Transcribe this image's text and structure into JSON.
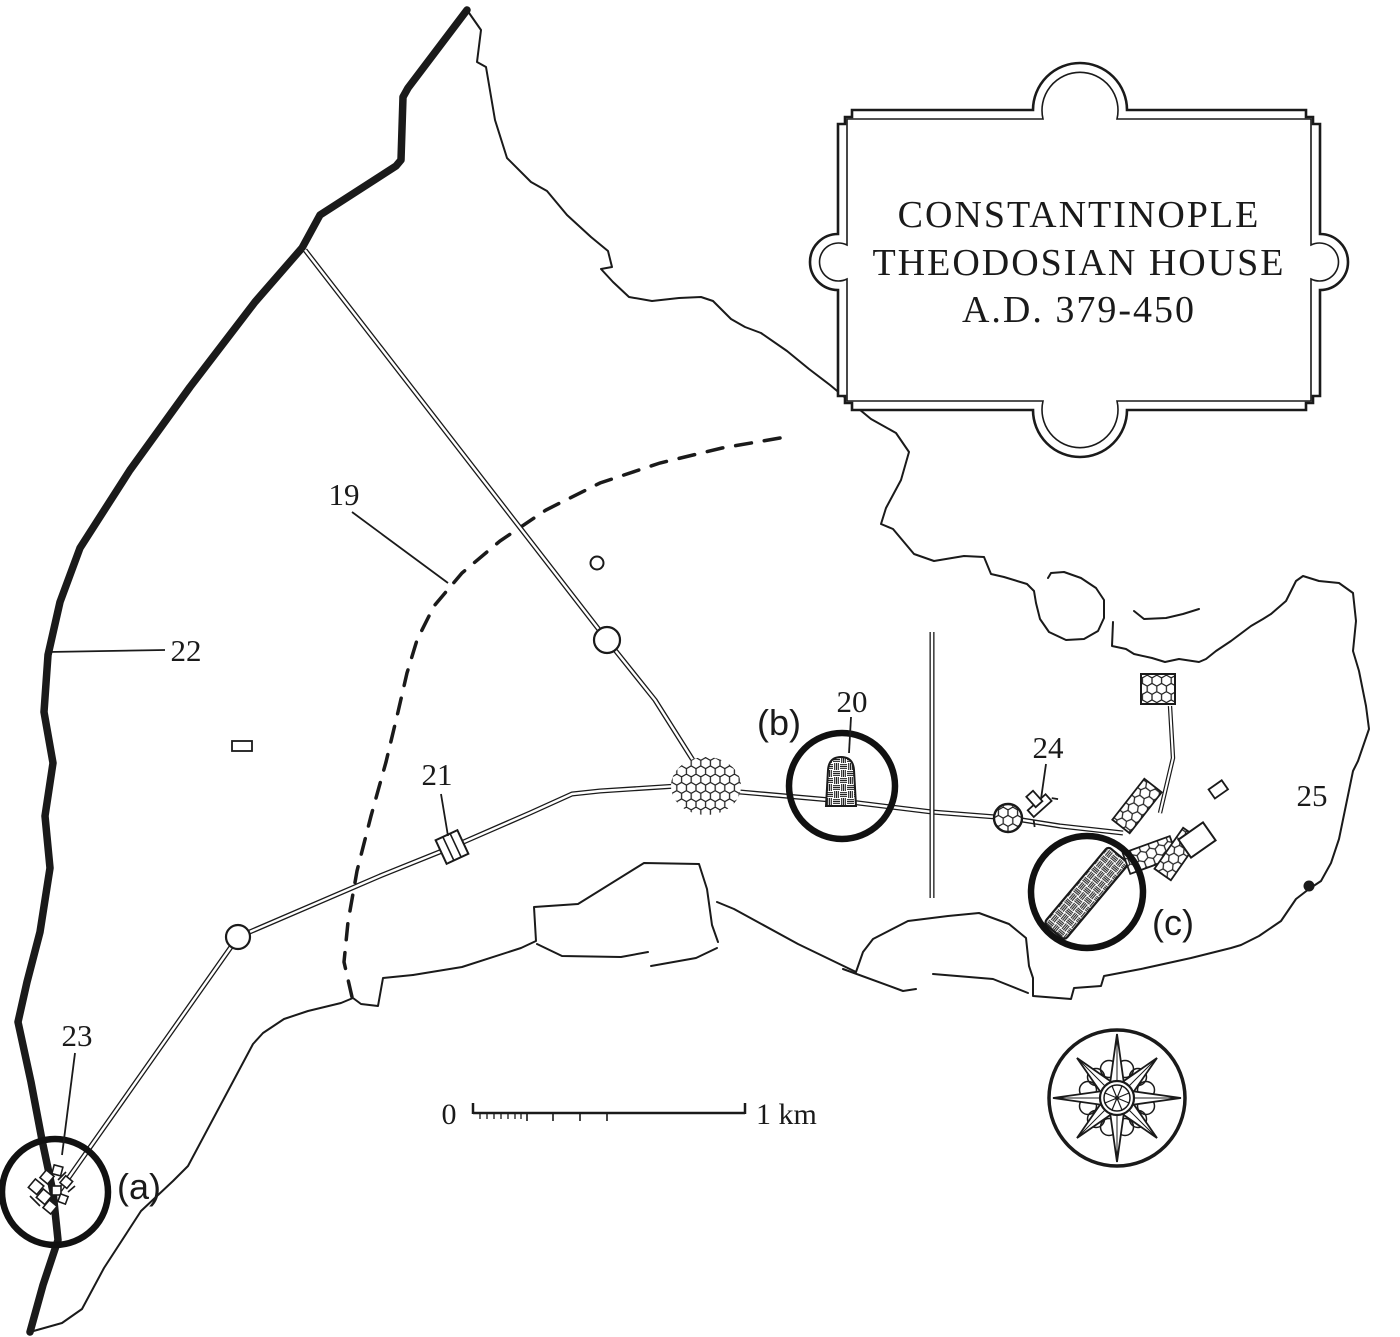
{
  "title_box": {
    "line1": "CONSTANTINOPLE",
    "line2": "THEODOSIAN HOUSE",
    "line3": "A.D. 379-450"
  },
  "labels": {
    "l19": "19",
    "l20": "20",
    "l21": "21",
    "l22": "22",
    "l23": "23",
    "l24": "24",
    "l25": "25",
    "a": "(a)",
    "b": "(b)",
    "c": "(c)"
  },
  "scale_bar": {
    "zero": "0",
    "one_km": "1 km"
  },
  "colors": {
    "ink": "#1a1a1a",
    "paper": "#ffffff"
  }
}
